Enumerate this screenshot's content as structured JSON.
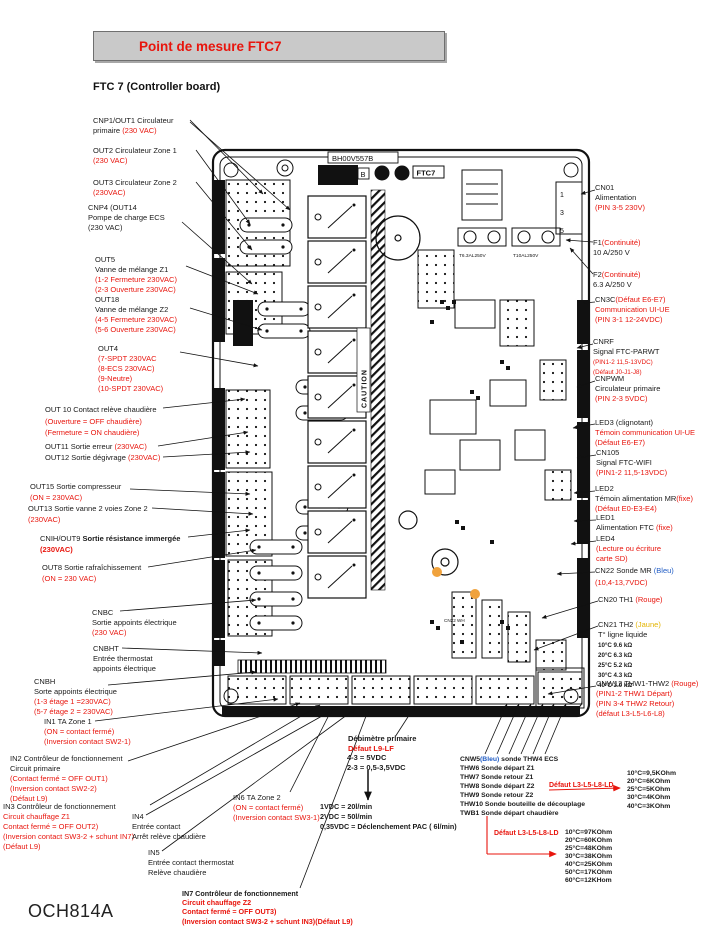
{
  "title": "Point de mesure FTC7",
  "subtitle": "FTC 7 (Controller board)",
  "footer": "OCH814A",
  "colors": {
    "accent_red": "#e8150d",
    "blue": "#1f5bc4",
    "yellow": "#e3b400",
    "title_box_gray": "#c9c9c9"
  },
  "board": {
    "part_number": "BH00V557B",
    "rev": "B",
    "model": "FTC7",
    "caution": "CAUTION",
    "fuse1": "T6.3AL250V",
    "fuse2": "T10AL250V",
    "cn01_pins": [
      "1",
      "3",
      "5"
    ],
    "cn22_label": "CN22 WH"
  },
  "callouts": {
    "cnp1": [
      [
        {
          "t": "CNP1/OUT1 Circulateur",
          "c": "k"
        }
      ],
      [
        {
          "t": "primaire ",
          "c": "k"
        },
        {
          "t": "(230 VAC)",
          "c": "r"
        }
      ]
    ],
    "out2": [
      [
        {
          "t": "OUT2 Circulateur Zone 1",
          "c": "k"
        }
      ],
      [
        {
          "t": "(230 VAC)",
          "c": "r"
        }
      ]
    ],
    "out3": [
      [
        {
          "t": "OUT3 Circulateur Zone 2",
          "c": "k"
        }
      ],
      [
        {
          "t": "(230VAC)",
          "c": "r"
        }
      ]
    ],
    "cnp4": [
      [
        {
          "t": "CNP4 (OUT14",
          "c": "k"
        }
      ],
      [
        {
          "t": "Pompe de charge ECS",
          "c": "k"
        }
      ],
      [
        {
          "t": "(230 VAC)",
          "c": "k"
        }
      ]
    ],
    "out5": [
      [
        {
          "t": "OUT5",
          "c": "k"
        }
      ],
      [
        {
          "t": "Vanne de mélange Z1",
          "c": "k"
        }
      ],
      [
        {
          "t": "(1-2 Fermeture 230VAC)",
          "c": "r"
        }
      ],
      [
        {
          "t": "(2-3 Ouverture 230VAC)",
          "c": "r"
        }
      ]
    ],
    "out18": [
      [
        {
          "t": "OUT18",
          "c": "k"
        }
      ],
      [
        {
          "t": "Vanne de mélange Z2",
          "c": "k"
        }
      ],
      [
        {
          "t": "(4-5 Fermeture 230VAC)",
          "c": "r"
        }
      ],
      [
        {
          "t": "(5-6 Ouverture 230VAC)",
          "c": "r"
        }
      ]
    ],
    "out4": [
      [
        {
          "t": "OUT4",
          "c": "k"
        }
      ],
      [
        {
          "t": "(7-SPDT 230VAC",
          "c": "r"
        }
      ],
      [
        {
          "t": "(8-ECS 230VAC)",
          "c": "r"
        }
      ],
      [
        {
          "t": "(9-Neutre)",
          "c": "r"
        }
      ],
      [
        {
          "t": "(10-SPDT 230VAC)",
          "c": "r"
        }
      ]
    ],
    "out10": [
      [
        {
          "t": "OUT 10 Contact relève chaudière",
          "c": "k"
        }
      ],
      [
        {
          "t": "(Ouverture = OFF chaudière)",
          "c": "r"
        }
      ],
      [
        {
          "t": "(Fermeture = ON chaudière)",
          "c": "r"
        }
      ]
    ],
    "out11": [
      [
        {
          "t": "OUT11 Sortie erreur ",
          "c": "k"
        },
        {
          "t": "(230VAC)",
          "c": "r"
        }
      ]
    ],
    "out12": [
      [
        {
          "t": "OUT12 Sortie dégivrage ",
          "c": "k"
        },
        {
          "t": "(230VAC)",
          "c": "r"
        }
      ]
    ],
    "out15": [
      [
        {
          "t": "OUT15 Sortie compresseur",
          "c": "k"
        }
      ],
      [
        {
          "t": "(ON = 230VAC)",
          "c": "r"
        }
      ]
    ],
    "out13": [
      [
        {
          "t": "OUT13 Sortie vanne 2 voies Zone 2",
          "c": "k"
        }
      ],
      [
        {
          "t": "(230VAC)",
          "c": "r"
        }
      ]
    ],
    "cnih": [
      [
        {
          "t": "CNIH/OUT9 ",
          "c": "k"
        },
        {
          "t": "Sortie résistance immergée",
          "c": "k",
          "b": 1
        }
      ],
      [
        {
          "t": "(230VAC)",
          "c": "r",
          "b": 1
        }
      ]
    ],
    "out8": [
      [
        {
          "t": "OUT8 Sortie rafraîchissement",
          "c": "k"
        }
      ],
      [
        {
          "t": "(ON = 230 VAC)",
          "c": "r"
        }
      ]
    ],
    "cnbc": [
      [
        {
          "t": "CNBC",
          "c": "k"
        }
      ],
      [
        {
          "t": "Sortie appoints électrique",
          "c": "k"
        }
      ],
      [
        {
          "t": "(230 VAC)",
          "c": "r"
        }
      ]
    ],
    "cnbht": [
      [
        {
          "t": "CNBHT",
          "c": "k"
        }
      ],
      [
        {
          "t": "Entrée thermostat",
          "c": "k"
        }
      ],
      [
        {
          "t": "appoints électrique",
          "c": "k"
        }
      ]
    ],
    "cnbh": [
      [
        {
          "t": "CNBH",
          "c": "k"
        }
      ],
      [
        {
          "t": "Sorte appoints électrique",
          "c": "k"
        }
      ],
      [
        {
          "t": "(1-3 étage 1 =230VAC)",
          "c": "r"
        }
      ],
      [
        {
          "t": "(5-7 étage 2 = 230VAC)",
          "c": "r"
        }
      ]
    ],
    "in1": [
      [
        {
          "t": "IN1 TA Zone 1",
          "c": "k"
        }
      ],
      [
        {
          "t": "(ON = contact  fermé)",
          "c": "r"
        }
      ],
      [
        {
          "t": "(Inversion contact SW2-1)",
          "c": "r"
        }
      ]
    ],
    "in2": [
      [
        {
          "t": "IN2 Contrôleur de fonctionnement",
          "c": "k"
        }
      ],
      [
        {
          "t": "Circuit primaire",
          "c": "k"
        }
      ],
      [
        {
          "t": "(Contact fermé = OFF OUT1)",
          "c": "r"
        }
      ],
      [
        {
          "t": "(Inversion contact SW2-2)",
          "c": "r"
        }
      ],
      [
        {
          "t": "(Défaut L9)",
          "c": "r"
        }
      ]
    ],
    "in3": [
      [
        {
          "t": "IN3 Contrôleur de fonctionnement",
          "c": "k"
        }
      ],
      [
        {
          "t": "Circuit chauffage Z1",
          "c": "r"
        }
      ],
      [
        {
          "t": "Contact fermé = OFF OUT2)",
          "c": "r"
        }
      ],
      [
        {
          "t": "(Inversion contact SW3-2 + schunt IN7)",
          "c": "r"
        }
      ],
      [
        {
          "t": "(Défaut L9)",
          "c": "r"
        }
      ]
    ],
    "in4": [
      [
        {
          "t": "IN4",
          "c": "k"
        }
      ],
      [
        {
          "t": "Entrée contact",
          "c": "k"
        }
      ],
      [
        {
          "t": "Arrêt relève chaudière",
          "c": "k"
        }
      ]
    ],
    "in5": [
      [
        {
          "t": "IN5",
          "c": "k"
        }
      ],
      [
        {
          "t": "Entrée contact thermostat",
          "c": "k"
        }
      ],
      [
        {
          "t": "Relève chaudière",
          "c": "k"
        }
      ]
    ],
    "in6": [
      [
        {
          "t": "IN6 TA Zone 2",
          "c": "k"
        }
      ],
      [
        {
          "t": "(ON = contact  fermé)",
          "c": "r"
        }
      ],
      [
        {
          "t": "(Inversion contact SW3-1)",
          "c": "r"
        }
      ]
    ],
    "in7": [
      [
        {
          "t": "IN7 Contrôleur de fonctionnement",
          "c": "k",
          "b": 1
        }
      ],
      [
        {
          "t": "Circuit chauffage Z2",
          "c": "r",
          "b": 1
        }
      ],
      [
        {
          "t": "Contact fermé = OFF OUT3)",
          "c": "r",
          "b": 1
        }
      ],
      [
        {
          "t": "(Inversion contact SW3-2 + schunt IN3)(Défaut L9)",
          "c": "r",
          "b": 1
        }
      ]
    ],
    "cn01": [
      [
        {
          "t": "CN01",
          "c": "k"
        }
      ],
      [
        {
          "t": "Alimentation",
          "c": "k"
        }
      ],
      [
        {
          "t": "(PIN 3-5 230V)",
          "c": "r"
        }
      ]
    ],
    "f1": [
      [
        {
          "t": "F1",
          "c": "k"
        },
        {
          "t": "(Continuité)",
          "c": "r"
        }
      ],
      [
        {
          "t": "10 A/250 V",
          "c": "k"
        }
      ]
    ],
    "f2": [
      [
        {
          "t": "F2",
          "c": "k"
        },
        {
          "t": "(Continuité)",
          "c": "r"
        }
      ],
      [
        {
          "t": "6.3 A/250 V",
          "c": "k"
        }
      ]
    ],
    "cn3c": [
      [
        {
          "t": "CN3C",
          "c": "k"
        },
        {
          "t": "(Défaut E6-E7)",
          "c": "r"
        }
      ],
      [
        {
          "t": "Communication UI-UE",
          "c": "r"
        }
      ],
      [
        {
          "t": "(PIN 3-1 12-24VDC)",
          "c": "r"
        }
      ]
    ],
    "cnrf": [
      [
        {
          "t": "CNRF",
          "c": "k"
        }
      ],
      [
        {
          "t": "Signal FTC-PARWT",
          "c": "k"
        }
      ],
      [
        {
          "t": "(PIN1-2 11,5-13VDC)",
          "c": "r",
          "s": 6.3
        }
      ],
      [
        {
          "t": "(Défaut J0-J1-J8)",
          "c": "r",
          "s": 6.3
        }
      ]
    ],
    "cnpwm": [
      [
        {
          "t": "CNPWM",
          "c": "k"
        }
      ],
      [
        {
          "t": "Circulateur primaire",
          "c": "k"
        }
      ],
      [
        {
          "t": "(PIN 2-3 5VDC)",
          "c": "r"
        }
      ]
    ],
    "led3": [
      [
        {
          "t": "LED3 (clignotant)",
          "c": "k"
        }
      ],
      [
        {
          "t": "Témoin communication UI-UE",
          "c": "r"
        }
      ],
      [
        {
          "t": "(Défaut E6-E7)",
          "c": "r"
        }
      ]
    ],
    "cn105": [
      [
        {
          "t": "CN105",
          "c": "k"
        }
      ],
      [
        {
          "t": "Signal FTC-WIFI",
          "c": "k"
        }
      ],
      [
        {
          "t": "(PIN1-2 11,5-13VDC)",
          "c": "r"
        }
      ]
    ],
    "led2": [
      [
        {
          "t": "LED2",
          "c": "k"
        }
      ],
      [
        {
          "t": "Témoin alimentation MR",
          "c": "k"
        },
        {
          "t": "(fixe)",
          "c": "r"
        }
      ],
      [
        {
          "t": "(Défaut E0-E3-E4)",
          "c": "r"
        }
      ]
    ],
    "led1": [
      [
        {
          "t": "LED1",
          "c": "k"
        }
      ],
      [
        {
          "t": "Alimentation FTC ",
          "c": "k"
        },
        {
          "t": "(fixe)",
          "c": "r"
        }
      ]
    ],
    "led4": [
      [
        {
          "t": "LED4",
          "c": "k"
        }
      ],
      [
        {
          "t": "(Lecture ou écriture",
          "c": "r"
        }
      ],
      [
        {
          "t": "carte SD)",
          "c": "r"
        }
      ]
    ],
    "cn22": [
      [
        {
          "t": "CN22 Sonde MR ",
          "c": "k"
        },
        {
          "t": "(Bleu)",
          "c": "b"
        }
      ],
      [
        {
          "t": "(10,4-13,7VDC)",
          "c": "r"
        }
      ]
    ],
    "cn20": [
      [
        {
          "t": "CN20 TH1 ",
          "c": "k"
        },
        {
          "t": "(Rouge)",
          "c": "r"
        }
      ]
    ],
    "cn21": [
      [
        {
          "t": "CN21 TH2 ",
          "c": "k"
        },
        {
          "t": "(Jaune)",
          "c": "y"
        }
      ],
      [
        {
          "t": "T° ligne liquide",
          "c": "k"
        }
      ],
      [
        {
          "t": "10°C 9.6 kΩ",
          "c": "k",
          "b": 1,
          "s": 6.2
        }
      ],
      [
        {
          "t": "20°C 6.3 kΩ",
          "c": "k",
          "b": 1,
          "s": 6.2
        }
      ],
      [
        {
          "t": "25°C 5.2 kΩ",
          "c": "k",
          "b": 1,
          "s": 6.2
        }
      ],
      [
        {
          "t": "30°C 4.3 kΩ",
          "c": "k",
          "b": 1,
          "s": 6.2
        }
      ],
      [
        {
          "t": "40°C 3.0 kΩ",
          "c": "k",
          "b": 1,
          "s": 6.2
        }
      ]
    ],
    "cnw12": [
      [
        {
          "t": "CNW12 THW1-THW2 ",
          "c": "k"
        },
        {
          "t": "(Rouge)",
          "c": "r"
        }
      ],
      [
        {
          "t": "(PIN1-2 THW1 Départ)",
          "c": "r"
        }
      ],
      [
        {
          "t": "(PIN 3-4 THW2 Retour)",
          "c": "r"
        }
      ],
      [
        {
          "t": "(défaut L3-L5-L6-L8)",
          "c": "r"
        }
      ]
    ],
    "debitmetre": [
      [
        {
          "t": "Débimètre primaire",
          "c": "k",
          "b": 1
        }
      ],
      [
        {
          "t": "Défaut L9-LF",
          "c": "r",
          "b": 1
        }
      ]
    ],
    "debit_vdc": [
      [
        {
          "t": "4-3 = 5VDC",
          "c": "k",
          "b": 1
        }
      ],
      [
        {
          "t": "2-3 = 0,5-3,5VDC",
          "c": "k",
          "b": 1
        }
      ]
    ],
    "debit_flow": [
      [
        {
          "t": "1VDC = 20l/min",
          "c": "k",
          "b": 1
        }
      ],
      [
        {
          "t": "2VDC = 50l/min",
          "c": "k",
          "b": 1
        }
      ],
      [
        {
          "t": "0,35VDC = Déclenchement PAC ( 6l/min)",
          "c": "k",
          "b": 1
        }
      ]
    ],
    "cnw5": [
      [
        {
          "t": "CNW5",
          "c": "k",
          "b": 1
        },
        {
          "t": "(Bleu)",
          "c": "b",
          "b": 1
        },
        {
          "t": " sonde THW4 ECS",
          "c": "k",
          "b": 1
        }
      ],
      [
        {
          "t": "THW6 Sonde départ Z1",
          "c": "k",
          "b": 1
        }
      ],
      [
        {
          "t": "THW7 Sonde retour Z1",
          "c": "k",
          "b": 1
        }
      ],
      [
        {
          "t": "THW8 Sonde départ Z2",
          "c": "k",
          "b": 1
        }
      ],
      [
        {
          "t": "THW9 Sonde retour Z2",
          "c": "k",
          "b": 1
        }
      ],
      [
        {
          "t": "THW10 Sonde bouteille de découplage",
          "c": "k",
          "b": 1
        }
      ],
      [
        {
          "t": "TWB1 Sonde départ chaudière",
          "c": "k",
          "b": 1
        }
      ]
    ],
    "defaut1": [
      [
        {
          "t": "Défaut L3-L5-L8-LD",
          "c": "r",
          "b": 1
        }
      ]
    ],
    "ohm1": [
      [
        {
          "t": "10°C=9,5KOhm",
          "c": "k",
          "b": 1
        }
      ],
      [
        {
          "t": "20°C=6KOhm",
          "c": "k",
          "b": 1
        }
      ],
      [
        {
          "t": "25°C=5KOhm",
          "c": "k",
          "b": 1
        }
      ],
      [
        {
          "t": "30°C=4KOhm",
          "c": "k",
          "b": 1
        }
      ],
      [
        {
          "t": "40°C=3KOhm",
          "c": "k",
          "b": 1
        }
      ]
    ],
    "defaut2": [
      [
        {
          "t": "Défaut L3-L5-L8-LD",
          "c": "r",
          "b": 1
        }
      ]
    ],
    "ohm2": [
      [
        {
          "t": "10°C=97KOhm",
          "c": "k",
          "b": 1
        }
      ],
      [
        {
          "t": "20°C=60KOhm",
          "c": "k",
          "b": 1
        }
      ],
      [
        {
          "t": "25°C=48KOhm",
          "c": "k",
          "b": 1
        }
      ],
      [
        {
          "t": "30°C=38KOhm",
          "c": "k",
          "b": 1
        }
      ],
      [
        {
          "t": "40°C=25KOhm",
          "c": "k",
          "b": 1
        }
      ],
      [
        {
          "t": "50°C=17KOhm",
          "c": "k",
          "b": 1
        }
      ],
      [
        {
          "t": "60°C=12KHom",
          "c": "k",
          "b": 1
        }
      ]
    ]
  }
}
